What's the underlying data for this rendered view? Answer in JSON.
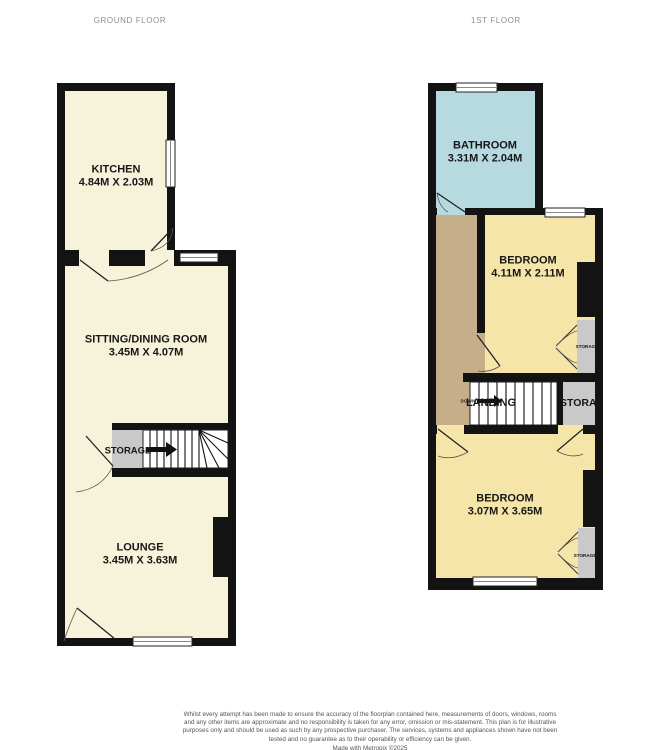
{
  "header": {
    "ground_floor_label": "GROUND FLOOR",
    "first_floor_label": "1ST FLOOR"
  },
  "ground_floor": {
    "kitchen": {
      "name": "KITCHEN",
      "dims": "4.84M X 2.03M"
    },
    "sitting_dining": {
      "name": "SITTING/DINING ROOM",
      "dims": "3.45M X 4.07M"
    },
    "storage": {
      "name": "STORAGE"
    },
    "lounge": {
      "name": "LOUNGE",
      "dims": "3.45M X 3.63M"
    }
  },
  "first_floor": {
    "bathroom": {
      "name": "BATHROOM",
      "dims": "3.31M X 2.04M"
    },
    "bedroom_rear": {
      "name": "BEDROOM",
      "dims": "4.11M X 2.11M"
    },
    "landing": {
      "name": "LANDING"
    },
    "down_label": "DOWN",
    "storage_upper": {
      "name": "STORAGE"
    },
    "storage_mid": {
      "name": "STORAGE"
    },
    "bedroom_front": {
      "name": "BEDROOM",
      "dims": "3.07M X 3.65M"
    },
    "storage_lower": {
      "name": "STORAGE"
    }
  },
  "footer": {
    "disclaimer": "Whilst every attempt has been made to ensure the accuracy of the floorplan contained here, measurements of doors, windows, rooms and any other items are approximate and no responsibility is taken for any error, omission or mis-statement. This plan is for illustrative purposes only and should be used as such by any prospective purchaser. The services, systems and appliances shown have not been tested and no guarantee as to their operability or efficiency can be given.",
    "credit": "Made with Metropix ©2025"
  },
  "colors": {
    "wall": "#131313",
    "room_cream": "#f7f3db",
    "room_yellow": "#f6e5a8",
    "bathroom_blue": "#b7dae1",
    "landing_tan": "#c7ae8b",
    "storage_gray": "#c9c9c9"
  }
}
